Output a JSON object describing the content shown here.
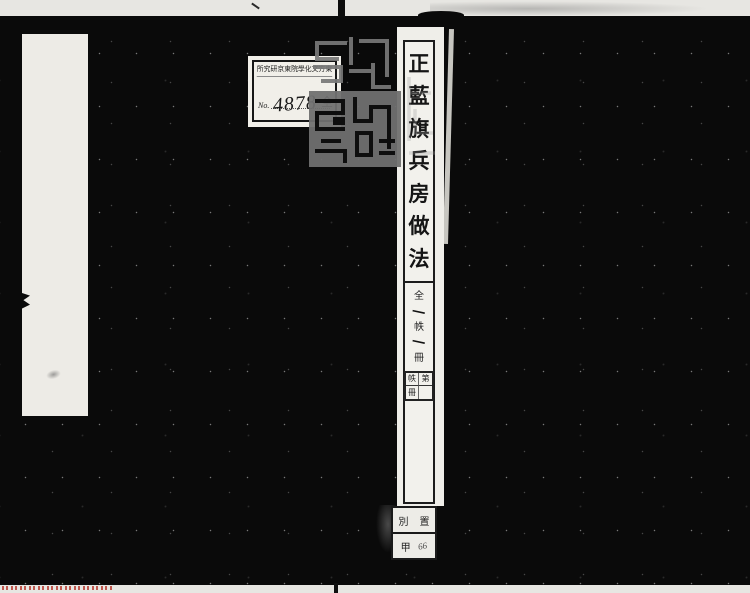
{
  "library_label": {
    "institution_rtl": "所究研京東院學化文方東",
    "no_label": "No.",
    "accession_number": "4878",
    "volume_note": "全"
  },
  "title_strip": {
    "chars": [
      "正",
      "藍",
      "旗",
      "兵",
      "房",
      "做",
      "法"
    ],
    "count": {
      "zen": "全",
      "one_a": "一",
      "chitsu": "帙",
      "one_b": "一",
      "satsu": "冊"
    },
    "form_box": {
      "r1c1": "帙",
      "r1c2": "第",
      "r2c1": "冊",
      "r2c2": ""
    }
  },
  "shelf_label": {
    "r1c1": "別",
    "r1c2": "置",
    "r2c1": "甲",
    "r2c2": "66"
  },
  "seal": {
    "name": "library-collection-seal",
    "color": "#787878"
  },
  "colors": {
    "cover": "#0a0a0a",
    "paper": "#efeee9",
    "watermark_red": "#b5342a"
  }
}
